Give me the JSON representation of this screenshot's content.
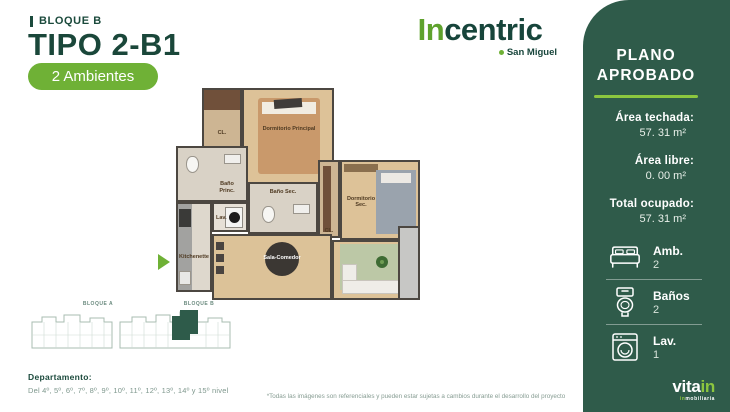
{
  "header": {
    "block": "BLOQUE B",
    "title": "TIPO 2-B1",
    "badge": "2 Ambientes"
  },
  "brand": {
    "logo_green": "In",
    "logo_dark": "centric",
    "location": "San Miguel"
  },
  "approval": {
    "line1": "PLANO",
    "line2": "APROBADO"
  },
  "areas": [
    {
      "label": "Área techada:",
      "value": "57. 31 m²"
    },
    {
      "label": "Área libre:",
      "value": "0. 00 m²"
    },
    {
      "label": "Total ocupado:",
      "value": "57. 31 m²"
    }
  ],
  "features": [
    {
      "icon": "bed-icon",
      "label": "Amb.",
      "value": "2"
    },
    {
      "icon": "toilet-icon",
      "label": "Baños",
      "value": "2"
    },
    {
      "icon": "washer-icon",
      "label": "Lav.",
      "value": "1"
    }
  ],
  "developer_logo": {
    "white": "vita",
    "green": "in",
    "tagline_green": "in",
    "tagline_white": "mobiliaria"
  },
  "floorplan": {
    "labels": {
      "closet1": "CL.",
      "dorm_principal": "Dormitorio Principal",
      "bano_princ": "Baño Princ.",
      "lav": "Lav.",
      "kitchenette": "Kitchenette",
      "bano_sec": "Baño Sec.",
      "closet2": "CL.",
      "dorm_sec": "Dormitorio Sec.",
      "sala": "Sala-Comedor"
    }
  },
  "keyplan": {
    "block_a": "BLOQUE A",
    "block_b": "BLOQUE B"
  },
  "department": {
    "label": "Departamento:",
    "levels": "Del 4º, 5º, 6º, 7º, 8º, 9º, 10º, 11º, 12º, 13º, 14º y 15º nivel"
  },
  "disclaimer": "*Todas las imágenes son referenciales y pueden estar sujetas a cambios durante el desarrollo del proyecto",
  "colors": {
    "accent_green": "#6fb136",
    "bright_green": "#8cc63f",
    "dark_green_text": "#1b4a3c",
    "sidebar_background": "#2f5b4a"
  }
}
